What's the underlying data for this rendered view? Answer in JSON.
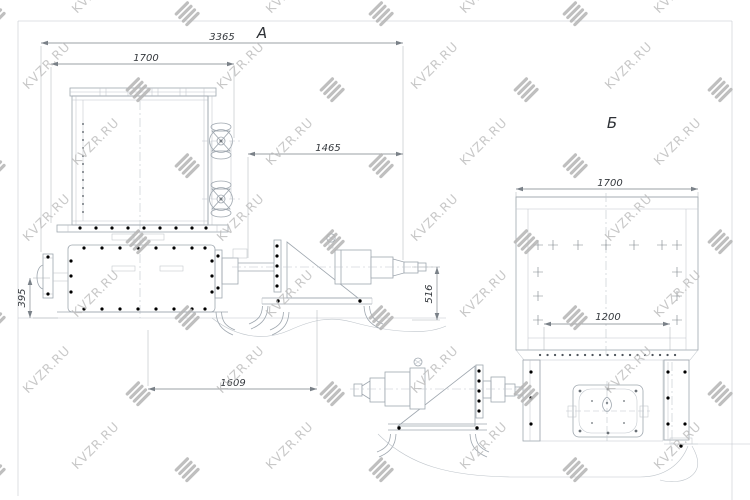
{
  "drawing": {
    "watermark": {
      "text": "KVZR.RU",
      "text_color": "#bdbdbd",
      "logo_color": "#b5b5b5"
    },
    "views": {
      "a_label": "А",
      "b_label": "Б"
    },
    "dimensions": {
      "a_overall_length": "3365",
      "a_body_width": "1700",
      "a_drive_length": "1465",
      "a_left_height": "395",
      "a_drive_height": "516",
      "a_base_length": "1609",
      "b_body_width": "1700",
      "b_opening_width": "1200"
    },
    "colors": {
      "background": "#ffffff",
      "machine_line": "#9fa7af",
      "dimension_line": "#7a8188",
      "dimension_text": "#34383d",
      "bolt_dark": "#4e545b",
      "watermark_text": "#bdbdbd",
      "watermark_logo": "#b5b5b5"
    }
  }
}
